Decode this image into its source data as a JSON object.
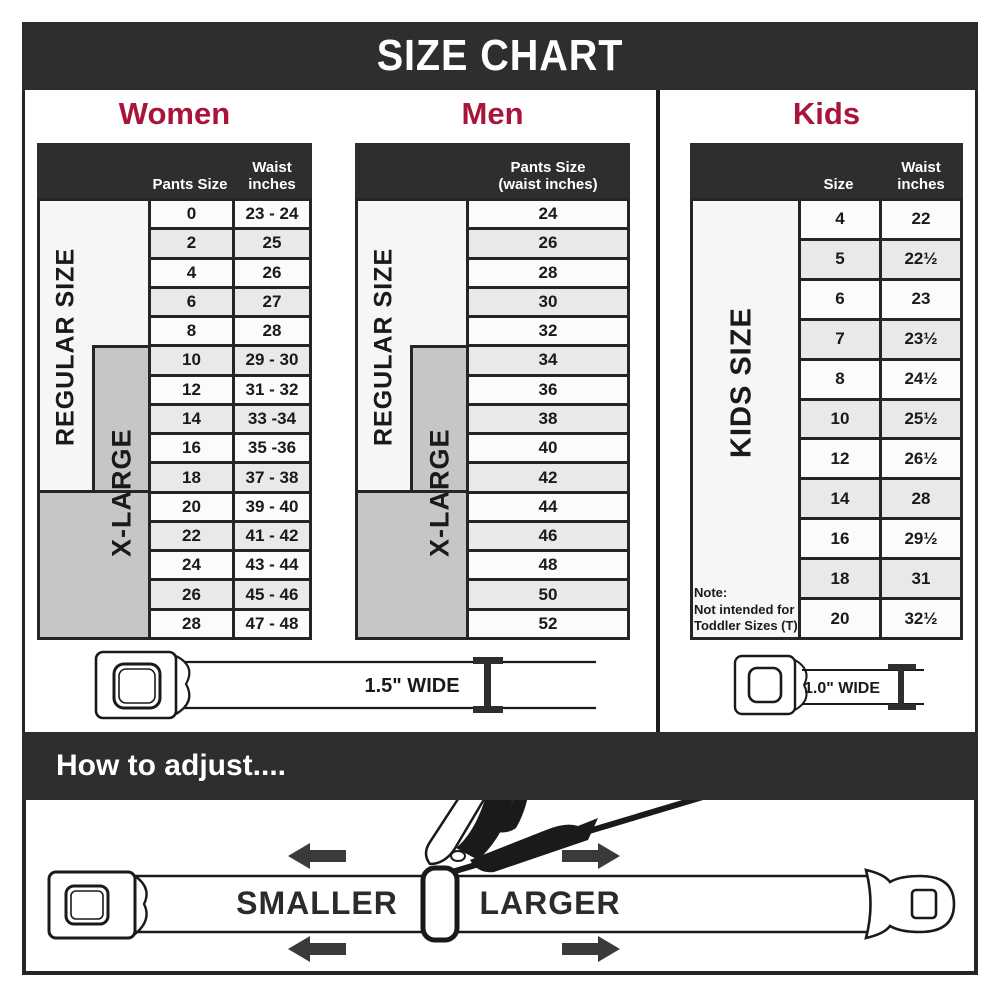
{
  "title": "SIZE CHART",
  "colors": {
    "band": "#2e2e2e",
    "accent": "#a8143a",
    "row_alt": "#e9e9e9",
    "gray_box": "#c6c6c6"
  },
  "sections": {
    "women": {
      "label": "Women",
      "col1_header": "Pants Size",
      "col2_header_line1": "Waist",
      "col2_header_line2": "inches",
      "regular_label": "REGULAR SIZE",
      "xlarge_label": "X-LARGE",
      "rows": [
        [
          "0",
          "23 - 24"
        ],
        [
          "2",
          "25"
        ],
        [
          "4",
          "26"
        ],
        [
          "6",
          "27"
        ],
        [
          "8",
          "28"
        ],
        [
          "10",
          "29 - 30"
        ],
        [
          "12",
          "31 - 32"
        ],
        [
          "14",
          "33 -34"
        ],
        [
          "16",
          "35 -36"
        ],
        [
          "18",
          "37 - 38"
        ],
        [
          "20",
          "39 - 40"
        ],
        [
          "22",
          "41 - 42"
        ],
        [
          "24",
          "43 - 44"
        ],
        [
          "26",
          "45 - 46"
        ],
        [
          "28",
          "47 - 48"
        ]
      ],
      "belt_label": "1.5\" WIDE"
    },
    "men": {
      "label": "Men",
      "col_header_line1": "Pants Size",
      "col_header_line2": "(waist inches)",
      "regular_label": "REGULAR SIZE",
      "xlarge_label": "X-LARGE",
      "rows": [
        "24",
        "26",
        "28",
        "30",
        "32",
        "34",
        "36",
        "38",
        "40",
        "42",
        "44",
        "46",
        "48",
        "50",
        "52"
      ]
    },
    "kids": {
      "label": "Kids",
      "col1_header": "Size",
      "col2_header_line1": "Waist",
      "col2_header_line2": "inches",
      "size_label": "KIDS SIZE",
      "note_line1": "Note:",
      "note_line2": "Not intended for",
      "note_line3": "Toddler Sizes (T)",
      "rows": [
        [
          "4",
          "22"
        ],
        [
          "5",
          "22½"
        ],
        [
          "6",
          "23"
        ],
        [
          "7",
          "23½"
        ],
        [
          "8",
          "24½"
        ],
        [
          "10",
          "25½"
        ],
        [
          "12",
          "26½"
        ],
        [
          "14",
          "28"
        ],
        [
          "16",
          "29½"
        ],
        [
          "18",
          "31"
        ],
        [
          "20",
          "32½"
        ]
      ],
      "belt_label": "1.0\" WIDE"
    }
  },
  "adjust": {
    "title": "How to adjust....",
    "smaller_label": "SMALLER",
    "larger_label": "LARGER"
  }
}
